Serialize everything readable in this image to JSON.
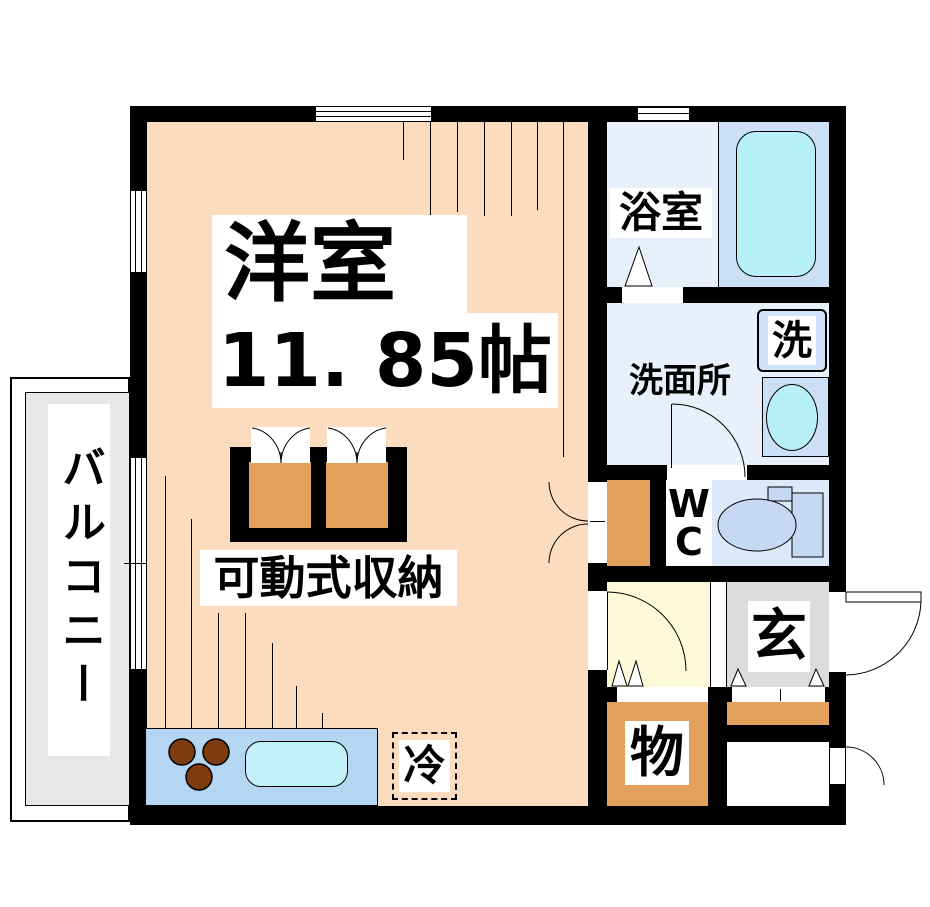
{
  "plan": {
    "labels": {
      "main_room_name": "洋室",
      "main_room_size": "11. 85帖",
      "balcony": "バルコニー",
      "bathroom": "浴室",
      "washroom": "洗面所",
      "washing_machine": "洗",
      "wc_line1": "W",
      "wc_line2": "C",
      "entrance": "玄",
      "storage_room": "物",
      "movable_storage": "可動式収納",
      "refrigerator": "冷"
    },
    "colors": {
      "wall": "#000000",
      "main_room_floor": "#fbdcbe",
      "balcony_floor": "#e8e8e8",
      "bathroom_floor": "#e7f0fb",
      "bathtub_zone": "#cbdff7",
      "bathtub_fill": "#b7f0f7",
      "washer_box": "#cfe4f8",
      "wc_floor": "#dce9f8",
      "toilet_fill": "#c5daf2",
      "hallway_floor": "#fcf9d8",
      "entrance_floor": "#dcdcdc",
      "storage_floor": "#e3a05c",
      "kitchen_counter": "#b5d6f2",
      "kitchen_sink": "#c2f1f9",
      "burner": "#7d3c0f"
    }
  }
}
